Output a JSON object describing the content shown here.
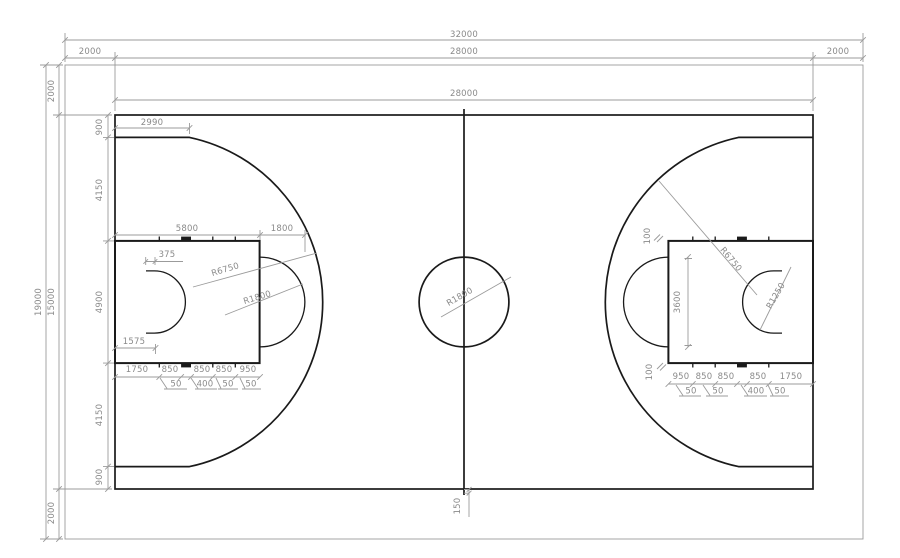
{
  "meta": {
    "drawing_type": "Basketball court dimensioned plan (CAD)"
  },
  "colors": {
    "background": "#ffffff",
    "court_line": "#1a1a1a",
    "dimension": "#9b9b9b",
    "dim_text": "#8a8a8a"
  },
  "top_dims": {
    "overall": "32000",
    "margin_left": "2000",
    "court_span": "28000",
    "margin_right": "2000",
    "court_inner": "28000"
  },
  "left_dims": {
    "overall": "19000",
    "margin_top": "2000",
    "court_span": "15000",
    "margin_bottom": "2000",
    "bands": [
      "900",
      "4150",
      "4900",
      "4150",
      "900"
    ]
  },
  "left_court": {
    "corner_offset": "2990",
    "key_depth": "5800",
    "ft_circle_ext": "1800",
    "backboard_to_rim": "375",
    "three_point_radius": "R6750",
    "ft_circle_radius": "R1800",
    "rim_to_baseline": "1575",
    "lane_marks": [
      "1750",
      "850",
      "850",
      "850",
      "950"
    ],
    "lane_mark_widths": [
      "50",
      "400",
      "50",
      "50"
    ]
  },
  "right_court": {
    "edge_mark_top": "100",
    "edge_mark_bottom": "100",
    "ft_line_length": "3600",
    "three_point_radius": "R6750",
    "restricted_radius": "R1250",
    "lane_marks": [
      "950",
      "850",
      "850",
      "850",
      "1750"
    ],
    "lane_mark_widths": [
      "50",
      "50",
      "400",
      "50"
    ]
  },
  "center_court": {
    "circle_radius": "R1800",
    "line_extension": "150"
  }
}
